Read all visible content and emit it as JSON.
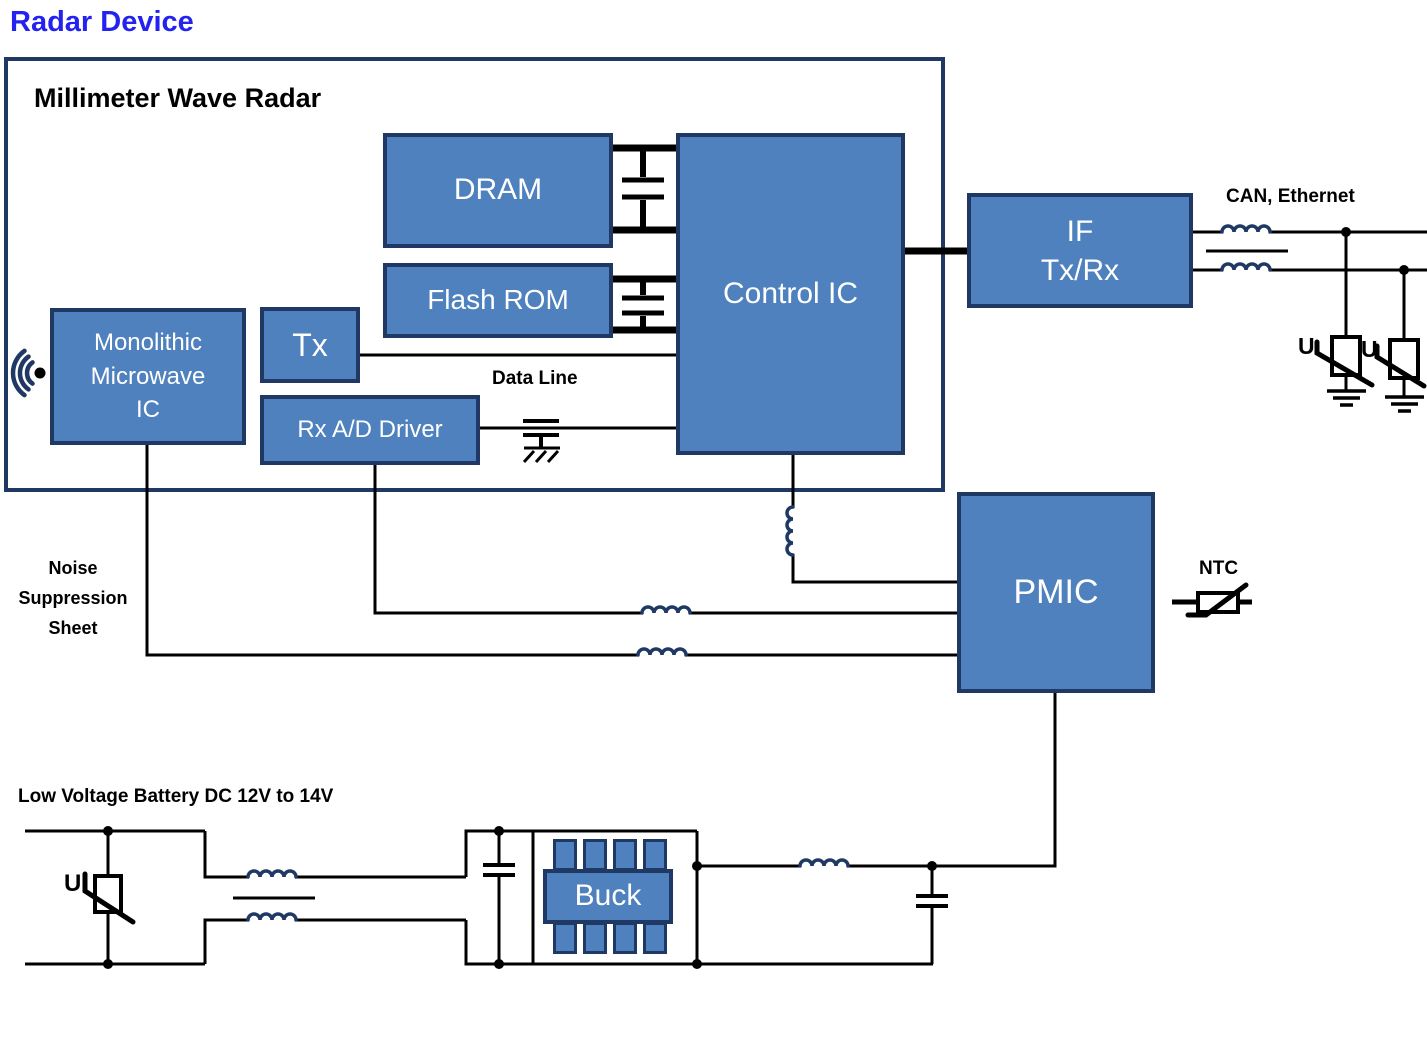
{
  "title": "Radar Device",
  "outer": {
    "label": "Millimeter Wave Radar"
  },
  "blocks": {
    "dram": "DRAM",
    "flash_rom": "Flash ROM",
    "control_ic": "Control IC",
    "tx": "Tx",
    "rx_ad_driver": "Rx A/D Driver",
    "mmic": {
      "line1": "Monolithic",
      "line2": "Microwave",
      "line3": "IC"
    },
    "if_txrx": {
      "line1": "IF",
      "line2": "Tx/Rx"
    },
    "pmic": "PMIC",
    "buck": "Buck"
  },
  "labels": {
    "data_line": "Data Line",
    "can_ethernet": "CAN, Ethernet",
    "ntc": "NTC",
    "noise_sheet": {
      "line1": "Noise",
      "line2": "Suppression",
      "line3": "Sheet"
    },
    "battery": "Low Voltage Battery DC 12V to 14V",
    "varistor_u": "U"
  },
  "colors": {
    "block_fill": "#4E81BD",
    "block_border": "#1F3864",
    "wire": "#000000",
    "coil": "#1F3864",
    "title_blue": "#2322F0"
  }
}
